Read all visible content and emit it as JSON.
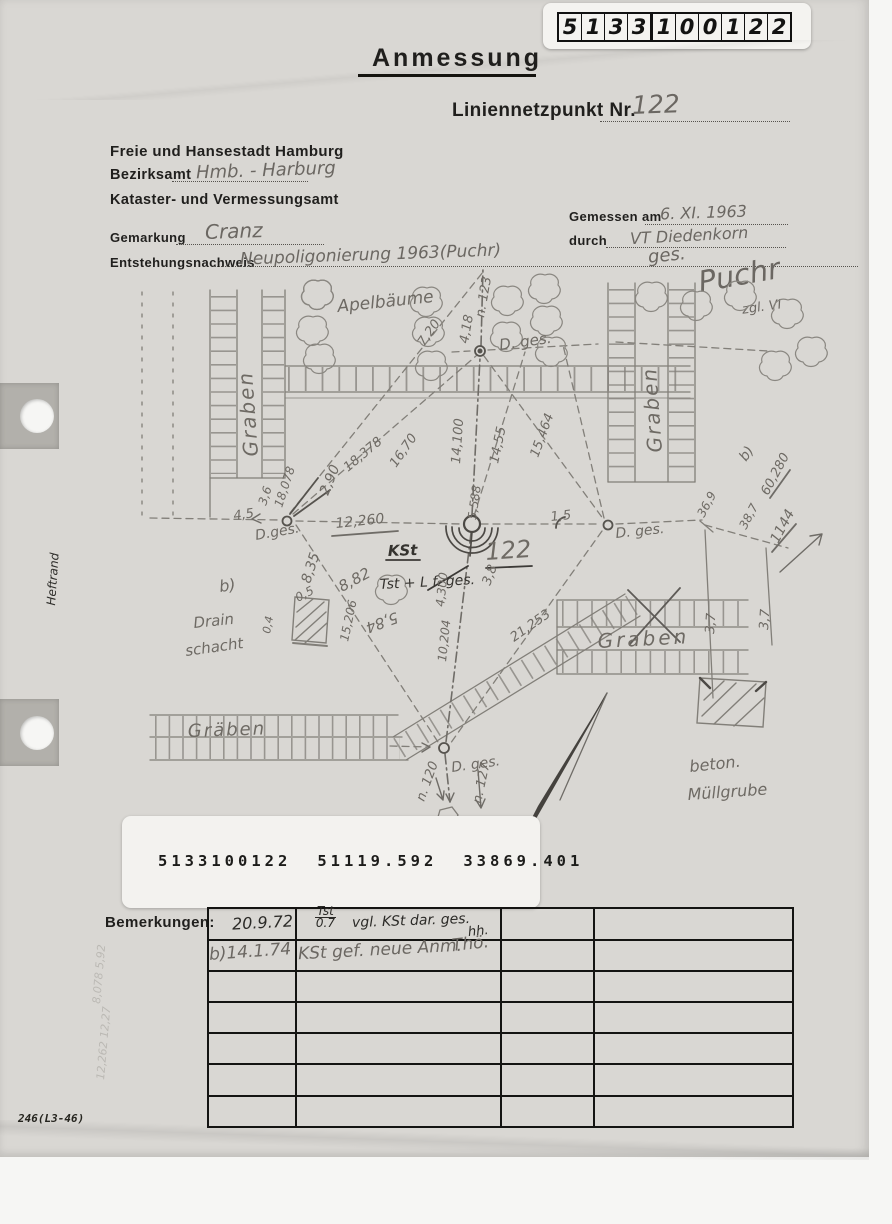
{
  "doc": {
    "boxes": [
      "5",
      "1",
      "3",
      "3",
      "1",
      "0",
      "0",
      "1",
      "2",
      "2"
    ],
    "title": "Anmessung",
    "point_label": "Liniennetzpunkt Nr.",
    "point_number": "122",
    "form_number": "246(L3-46)",
    "margin_label": "Heftrand"
  },
  "agency": {
    "line1": "Freie und Hansestadt Hamburg",
    "bezirksamt_label": "Bezirksamt",
    "bezirksamt_value": "Hmb. - Harburg",
    "line3": "Kataster- und Vermessungsamt"
  },
  "fields": {
    "gemessen_label": "Gemessen am",
    "gemessen_value": "6. XI. 1963",
    "durch_label": "durch",
    "durch_value": "VT Diedenkorn",
    "gemarkung_label": "Gemarkung",
    "gemarkung_value": "Cranz",
    "entstehung_label": "Entstehungsnachweis",
    "entstehung_value": "Neupoligonierung 1963(Puchr)",
    "sig_ges": "ges.",
    "sig_name": "Puchr",
    "sig_note": "zgl. VI"
  },
  "sticker": {
    "id": "5133100122",
    "coord_x": "51119.592",
    "coord_y": "33869.401"
  },
  "bemerkungen": {
    "label": "Bemerkungen:",
    "row1_date": "20.9.72",
    "row1_frac_top": "Tst",
    "row1_frac_bottom": "0.7",
    "row1_text": "vgl. KSt dar. ges.",
    "row1_initials": "hh.",
    "row2_date": "b)14.1.74",
    "row2_text": "KSt gef. neue Anm.",
    "row2_initials": "Thö."
  },
  "sketch": {
    "labels": [
      "Apelbäume",
      "Graben",
      "Graben",
      "Graben",
      "Gräben",
      "n. 123",
      "4,18",
      "7,20",
      "D. ges.",
      "D.ges.",
      "4,5",
      "3,6",
      "18,078",
      "2,90",
      "18,378",
      "16,70",
      "14,100",
      "14,55",
      "15,464",
      "12,260",
      "5,588",
      "1,5",
      "KSt",
      "Tst + L f. ges.",
      "122",
      "D. ges.",
      "b)",
      "60,280",
      "36,9",
      "38,7",
      "1144",
      "3,7",
      "3,7",
      "b)",
      "Drain",
      "schacht",
      "0,5",
      "0,4",
      "8,35",
      "8,82",
      "5,84",
      "15,206",
      "4,300",
      "10,204",
      "3,8",
      "21,253",
      "D. ges.",
      "n. 120",
      "n. 127",
      "beton.",
      "Müllgrube",
      "8,078  5,92",
      "12,262 12,27"
    ]
  },
  "colors": {
    "pencil": "#7e7b76",
    "ink": "#2b2a27",
    "paper": "#d9d7d3"
  }
}
